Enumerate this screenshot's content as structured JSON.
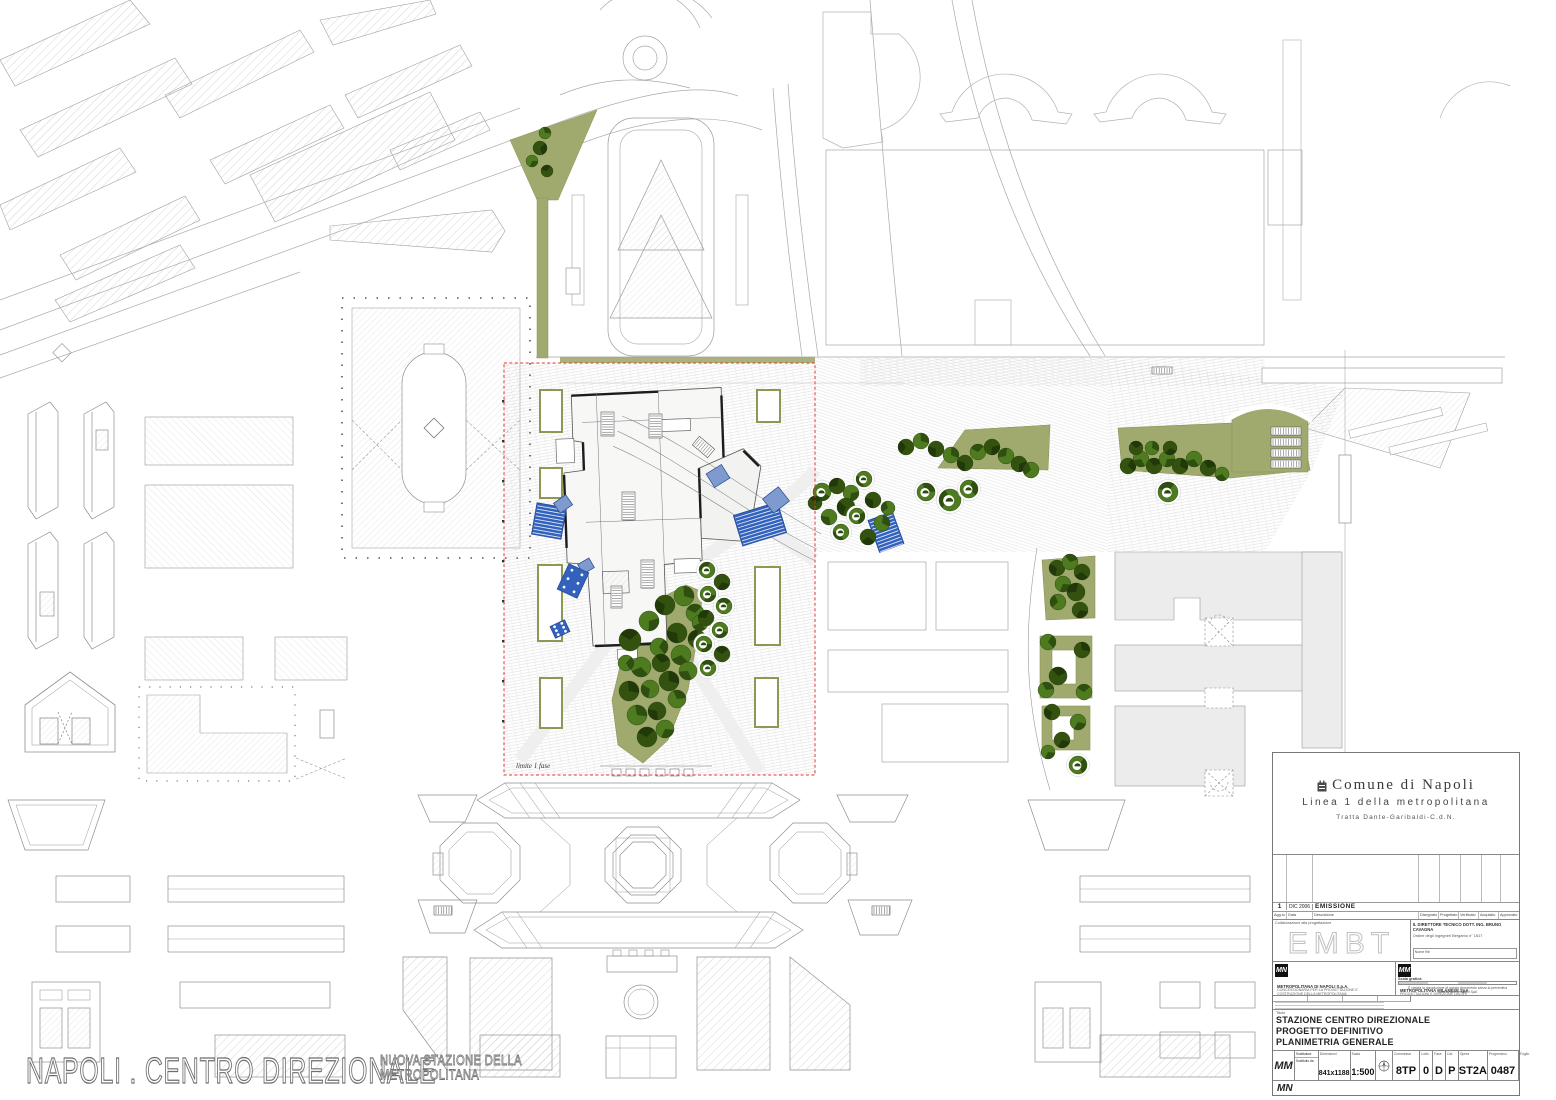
{
  "page": {
    "main_title": "NAPOLI . CENTRO DIREZIONALE",
    "subtitle_line1": "NUOVA STAZIONE DELLA",
    "subtitle_line2": "METROPOLITANA"
  },
  "map": {
    "phase_label": "limite 1 fase",
    "colors": {
      "park_green": "#a0aa6e",
      "tree_green": "#4e7b1f",
      "tree_dark": "#2c4a10",
      "canopy_blue": "#3262bd",
      "boundary_red": "#e0372c"
    },
    "trees": [
      {
        "name": "top-green",
        "items": [
          [
            545,
            133,
            6,
            "g"
          ],
          [
            540,
            148,
            7,
            "d"
          ],
          [
            532,
            161,
            6,
            "g"
          ],
          [
            547,
            171,
            6,
            "d"
          ]
        ]
      },
      {
        "name": "park",
        "items": [
          [
            630,
            640,
            11,
            "d"
          ],
          [
            649,
            621,
            10,
            "g"
          ],
          [
            665,
            605,
            10,
            "d"
          ],
          [
            684,
            596,
            10,
            "g"
          ],
          [
            659,
            647,
            9,
            "g"
          ],
          [
            677,
            633,
            10,
            "d"
          ],
          [
            695,
            613,
            9,
            "g"
          ],
          [
            641,
            667,
            10,
            "g"
          ],
          [
            661,
            663,
            9,
            "d"
          ],
          [
            681,
            655,
            10,
            "g"
          ],
          [
            697,
            639,
            9,
            "d"
          ],
          [
            629,
            691,
            10,
            "d"
          ],
          [
            650,
            689,
            9,
            "g"
          ],
          [
            669,
            681,
            10,
            "d"
          ],
          [
            688,
            671,
            9,
            "g"
          ],
          [
            637,
            715,
            10,
            "g"
          ],
          [
            657,
            711,
            9,
            "d"
          ],
          [
            677,
            699,
            9,
            "g"
          ],
          [
            647,
            737,
            10,
            "d"
          ],
          [
            665,
            729,
            9,
            "g"
          ],
          [
            626,
            663,
            8,
            "g"
          ],
          [
            700,
            623,
            8,
            "g"
          ]
        ]
      },
      {
        "name": "path",
        "items": [
          [
            707,
            570,
            8,
            "s"
          ],
          [
            722,
            582,
            8,
            "d"
          ],
          [
            708,
            594,
            8,
            "s"
          ],
          [
            724,
            606,
            8,
            "s"
          ],
          [
            706,
            618,
            8,
            "d"
          ],
          [
            720,
            630,
            8,
            "s"
          ],
          [
            704,
            644,
            8,
            "s"
          ],
          [
            722,
            654,
            8,
            "d"
          ],
          [
            708,
            668,
            8,
            "s"
          ]
        ]
      },
      {
        "name": "plaza-east",
        "items": [
          [
            822,
            492,
            9,
            "s"
          ],
          [
            837,
            486,
            8,
            "d"
          ],
          [
            851,
            493,
            8,
            "g"
          ],
          [
            864,
            479,
            8,
            "s"
          ],
          [
            846,
            507,
            9,
            "d"
          ],
          [
            829,
            517,
            8,
            "g"
          ],
          [
            857,
            516,
            8,
            "s"
          ],
          [
            873,
            500,
            8,
            "d"
          ],
          [
            882,
            523,
            8,
            "g"
          ],
          [
            841,
            532,
            8,
            "s"
          ],
          [
            815,
            503,
            7,
            "d"
          ],
          [
            868,
            537,
            8,
            "d"
          ],
          [
            888,
            508,
            7,
            "g"
          ]
        ]
      },
      {
        "name": "northeast",
        "items": [
          [
            906,
            447,
            8,
            "d"
          ],
          [
            921,
            441,
            8,
            "g"
          ],
          [
            936,
            449,
            8,
            "d"
          ],
          [
            951,
            455,
            8,
            "g"
          ],
          [
            965,
            463,
            8,
            "d"
          ],
          [
            978,
            452,
            8,
            "g"
          ],
          [
            992,
            447,
            8,
            "d"
          ],
          [
            1006,
            456,
            8,
            "g"
          ],
          [
            1019,
            464,
            8,
            "d"
          ],
          [
            1031,
            470,
            8,
            "g"
          ],
          [
            926,
            492,
            9,
            "s"
          ],
          [
            950,
            500,
            11,
            "s"
          ],
          [
            969,
            489,
            9,
            "s"
          ]
        ]
      },
      {
        "name": "east-wedge",
        "items": [
          [
            1128,
            466,
            8,
            "d"
          ],
          [
            1141,
            459,
            8,
            "g"
          ],
          [
            1154,
            466,
            8,
            "d"
          ],
          [
            1167,
            459,
            8,
            "g"
          ],
          [
            1152,
            448,
            7,
            "g"
          ],
          [
            1136,
            448,
            7,
            "d"
          ],
          [
            1180,
            466,
            8,
            "d"
          ],
          [
            1194,
            459,
            8,
            "g"
          ],
          [
            1208,
            468,
            8,
            "d"
          ],
          [
            1222,
            474,
            7,
            "g"
          ],
          [
            1170,
            448,
            7,
            "d"
          ],
          [
            1168,
            492,
            10,
            "s"
          ]
        ]
      },
      {
        "name": "east-strip",
        "items": [
          [
            1057,
            568,
            8,
            "d"
          ],
          [
            1070,
            562,
            8,
            "g"
          ],
          [
            1082,
            572,
            8,
            "d"
          ],
          [
            1063,
            584,
            8,
            "g"
          ],
          [
            1076,
            592,
            9,
            "d"
          ],
          [
            1058,
            602,
            8,
            "g"
          ],
          [
            1080,
            610,
            8,
            "d"
          ],
          [
            1048,
            642,
            8,
            "g"
          ],
          [
            1082,
            650,
            8,
            "d"
          ],
          [
            1058,
            676,
            9,
            "d"
          ],
          [
            1046,
            690,
            8,
            "g"
          ],
          [
            1084,
            692,
            8,
            "g"
          ],
          [
            1052,
            712,
            8,
            "d"
          ],
          [
            1078,
            722,
            8,
            "g"
          ],
          [
            1062,
            740,
            8,
            "d"
          ],
          [
            1048,
            752,
            7,
            "g"
          ],
          [
            1078,
            765,
            9,
            "s"
          ]
        ]
      }
    ],
    "canopies": [
      [
        549,
        521,
        30,
        32,
        10,
        "striped"
      ],
      [
        563,
        504,
        15,
        12,
        -35,
        "plain"
      ],
      [
        586,
        566,
        13,
        11,
        -30,
        "plain"
      ],
      [
        573,
        581,
        22,
        28,
        25,
        "dotted"
      ],
      [
        560,
        629,
        16,
        13,
        -25,
        "dotted"
      ],
      [
        718,
        476,
        18,
        16,
        -32,
        "plain"
      ],
      [
        760,
        524,
        46,
        32,
        -17,
        "striped"
      ],
      [
        776,
        500,
        20,
        18,
        -38,
        "plain"
      ],
      [
        886,
        532,
        26,
        34,
        -20,
        "striped"
      ]
    ],
    "escalators": [
      [
        601,
        412,
        13,
        24,
        0
      ],
      [
        649,
        414,
        13,
        24,
        0
      ],
      [
        698,
        437,
        11,
        20,
        -50
      ],
      [
        622,
        492,
        13,
        28,
        0
      ],
      [
        641,
        560,
        13,
        28,
        0
      ],
      [
        611,
        586,
        11,
        22,
        0
      ],
      [
        1271,
        427,
        30,
        8,
        0
      ],
      [
        1271,
        438,
        30,
        8,
        0
      ],
      [
        1271,
        449,
        30,
        8,
        0
      ],
      [
        1271,
        460,
        30,
        8,
        0
      ],
      [
        1152,
        367,
        20,
        7,
        0
      ],
      [
        872,
        906,
        18,
        9,
        0
      ],
      [
        434,
        906,
        18,
        9,
        0
      ]
    ]
  },
  "titleblock": {
    "comune": "Comune di Napoli",
    "linea": "Linea 1 della metropolitana",
    "tratta": "Tratta Dante-Garibaldi-C.d.N.",
    "rev": {
      "n": "1",
      "date": "DIC 2006",
      "desc": "EMISSIONE"
    },
    "rev_headers": [
      "Agg.to",
      "Data",
      "Descrizione",
      "Disegnato",
      "Progettato",
      "Verificato",
      "Acquisito",
      "Approvato"
    ],
    "collab_label": "Collaborazione alla progettazione",
    "collab_logo": "EMBT",
    "director_line1": "IL DIRETTORE TECNICO DOTT. ING. BRUNO CAVAGNA",
    "director_line2": "Ordine degli Ingegneri Bergamo n° 1617",
    "nome_file_label": "Nome file",
    "mn_logo": "MN",
    "mn_name": "METROPOLITANA DI NAPOLI S.p.A.",
    "mn_desc": "CONCESSIONARIA PER LA PROGETTAZIONE E COSTRUZIONE DELLA METROPOLITANA",
    "mm_logo": "MM",
    "mm_name": "METROPOLITANA MILANESE SpA",
    "mm_desc": "PROGETTAZIONI E DIREZIONE LAVORI",
    "scala_grafica_label": "Scala grafica",
    "disclaimer": "È vietata la riproduzione di questo documento senza la preventiva autorizzazione di MN SpA",
    "titolo_label": "Titolo",
    "project_title_lines": [
      "STAZIONE CENTRO DIREZIONALE",
      "PROGETTO DEFINITIVO",
      "PLANIMETRIA GENERALE"
    ],
    "mm_small": "MM",
    "mn_small": "MN",
    "fields": {
      "sost1": "Sostituisce",
      "sost2": "Sostituito da",
      "dim_label": "Dimensioni",
      "dim_value": "841x1188",
      "scala_label": "Scala",
      "scala_value": "1:500",
      "commessa_label": "Commessa",
      "commessa_value": "8TP",
      "lotto_label": "Lotto",
      "lotto_value": "0",
      "fase_label": "Fase",
      "fase_value": "D",
      "cat_label": "Cat.",
      "cat_value": "P",
      "opera_label": "Opera",
      "opera_value": "ST2A",
      "progressivo_label": "Progressivo",
      "progressivo_value": "0487",
      "foglio_label": "Foglio",
      "foglio_value": ""
    }
  }
}
